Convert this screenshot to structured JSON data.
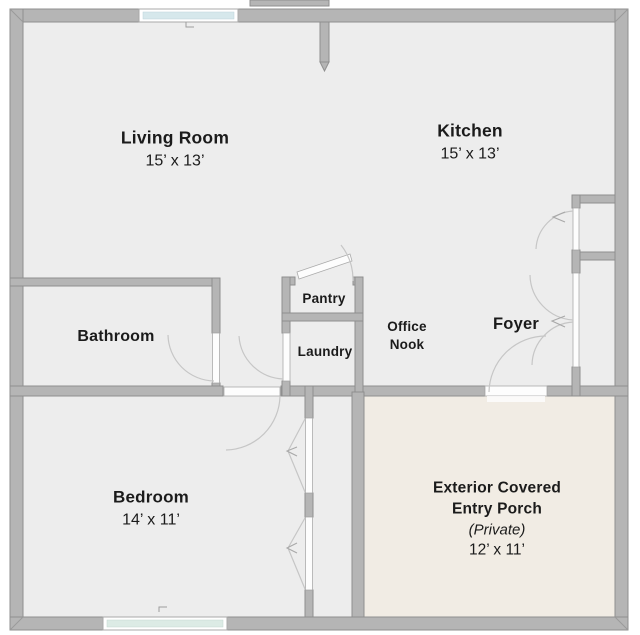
{
  "floorplan": {
    "rooms": [
      {
        "id": "living-room",
        "label": "Living Room",
        "dimensions": "15’ x 13’"
      },
      {
        "id": "kitchen",
        "label": "Kitchen",
        "dimensions": "15’ x 13’"
      },
      {
        "id": "bathroom",
        "label": "Bathroom"
      },
      {
        "id": "pantry",
        "label": "Pantry"
      },
      {
        "id": "laundry",
        "label": "Laundry"
      },
      {
        "id": "office-nook",
        "label_line1": "Office",
        "label_line2": "Nook"
      },
      {
        "id": "foyer",
        "label": "Foyer"
      },
      {
        "id": "bedroom",
        "label": "Bedroom",
        "dimensions": "14’ x 11’"
      },
      {
        "id": "entry-porch",
        "label_line1": "Exterior Covered",
        "label_line2": "Entry Porch",
        "note": "(Private)",
        "dimensions": "12’ x 11’"
      }
    ],
    "colors": {
      "wall": "#b5b5b5",
      "wall_outline": "#8f8f8f",
      "interior_floor": "#ededed",
      "porch_floor": "#f1ece4",
      "window_glass": "#d6e8ec",
      "window_glass_bottom": "#dcebe5",
      "door_leaf": "#ffffff",
      "swing_arc": "#c6c6c6",
      "background": "#ffffff"
    }
  }
}
